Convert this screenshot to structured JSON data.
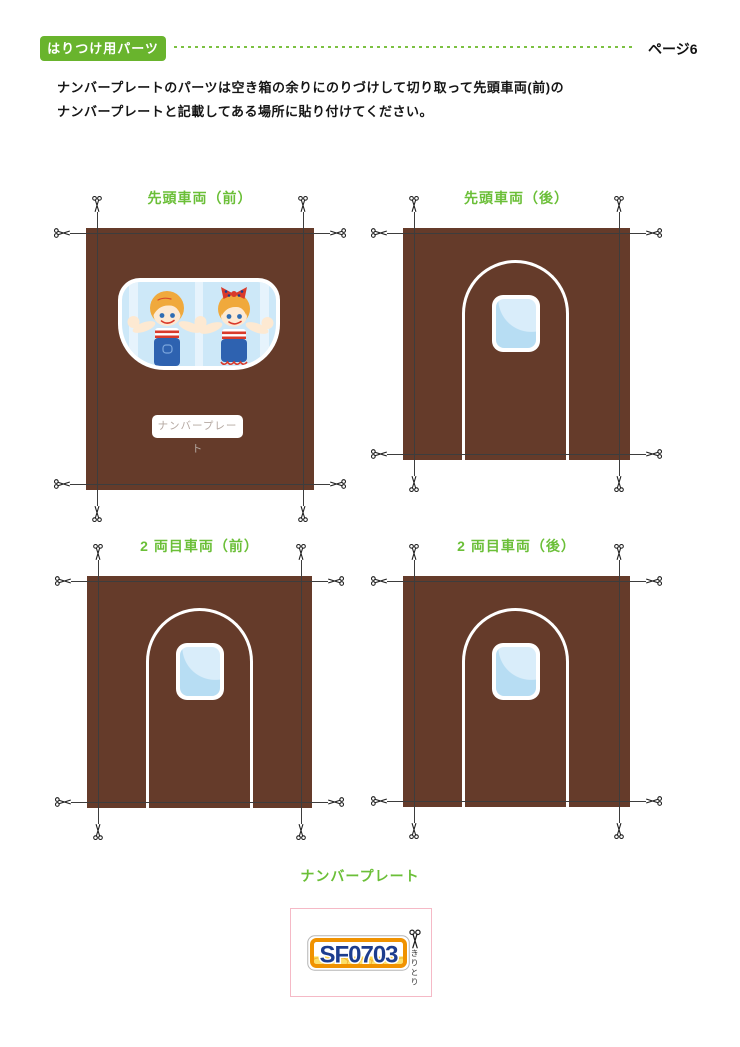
{
  "header": {
    "badge_label": "はりつけ用パーツ",
    "page_label": "ページ6"
  },
  "instructions": {
    "line1": "ナンバープレートのパーツは空き箱の余りにのりづけして切り取って先頭車両(前)の",
    "line2": "ナンバープレートと記載してある場所に貼り付けてください。"
  },
  "panels": [
    {
      "title": "先頭車両（前）",
      "type": "front-window-with-kids",
      "plate_placeholder": "ナンバープレート"
    },
    {
      "title": "先頭車両（後）",
      "type": "door-with-window"
    },
    {
      "title": "2 両目車両（前）",
      "type": "door-with-window"
    },
    {
      "title": "2 両目車両（後）",
      "type": "door-with-window"
    }
  ],
  "plate_section": {
    "label": "ナンバープレート",
    "plate_number": "SF0703",
    "cut_label": "きりとり"
  },
  "colors": {
    "accent_green": "#69b42d",
    "title_green": "#6bbf38",
    "panel_brown": "#653b2a",
    "glass_blue": "#b7ddf3",
    "plate_orange": "#f09200",
    "plate_yellow": "#ffd844",
    "plate_navy": "#1d3d8e",
    "box_pink": "#f5b9c6"
  }
}
